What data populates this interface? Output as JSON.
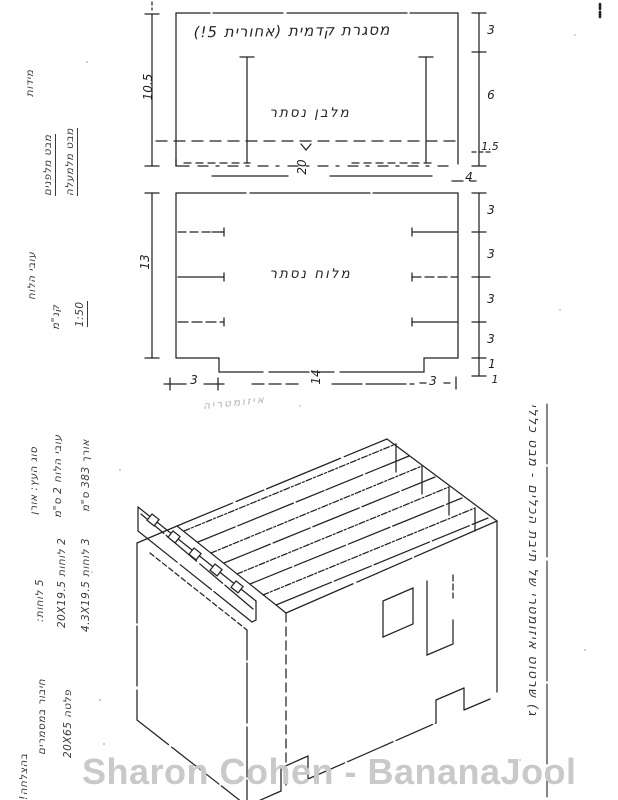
{
  "watermark": "Sharon Cohen - BananaJool",
  "top_diagram": {
    "title": "מסגרת קדמית (אחורית 5!)",
    "center_label": "מלבן נסתר",
    "dim_left": "10.5",
    "dim_right_top": "3",
    "dim_right_middle": "6",
    "dim_right_bottom": "1.5",
    "dim_bottom_width": "20",
    "dim_bottom_right": "4"
  },
  "middle_diagram": {
    "center_label": "מלוח נסתר",
    "dim_left": "13",
    "dim_right": [
      "3",
      "3",
      "3",
      "3",
      "1"
    ],
    "dim_corner": "1",
    "dim_bottom_left": "3",
    "dim_bottom_center": "14",
    "dim_bottom_right": "3"
  },
  "iso_view": {
    "faint_label": "איזומטריה"
  },
  "left_margin": {
    "note_views_1": "מידות",
    "note_views_2": "מבט מלפנים",
    "note_views_3": "מבט מלמעלה",
    "note_thickness": "עובי הלוח",
    "note_scale_word": "קנ\"מ",
    "note_scale_value": "1:50",
    "note_wood_type": "סוג העץ: אורן",
    "note_wood_thick": "עובי הלוח 2 ס\"מ",
    "note_wood_len": "אורך 383 ס\"מ",
    "note_boards_title": "5 לוחות:",
    "note_boards_a": "2 לוחות 20X19.5",
    "note_boards_b": "3 לוחות 4.3X19.5",
    "note_join": "חיבור במסמרים",
    "note_plate": "פלטה 20X65",
    "note_end": "בהצלחה!"
  },
  "right_margin": {
    "title": "ג) שרטוט איזומטרי של תיבת הכלים - מבט כללי"
  }
}
